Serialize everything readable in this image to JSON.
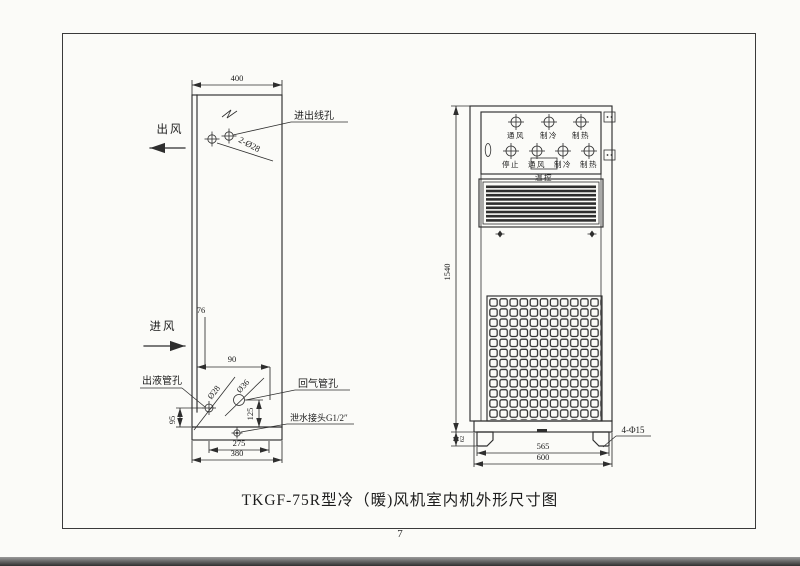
{
  "colors": {
    "ink": "#2e2e2e",
    "paper": "#fbfbf8",
    "frame": "#3a3a3a"
  },
  "page": {
    "title": "TKGF-75R型冷（暖)风机室内机外形尺寸图",
    "page_number": "7"
  },
  "side_view": {
    "air_out_label": "出风",
    "air_in_label": "进风",
    "wire_hole_label": "进出线孔",
    "wire_hole_spec": "2-Ø28",
    "liquid_hole_label": "出液管孔",
    "liquid_hole_spec": "Ø28",
    "gas_hole_label": "回气管孔",
    "gas_hole_spec": "Ø36",
    "drain_label": "泄水接头G1/2″",
    "dim_depth": "400",
    "dim_76": "76",
    "dim_90": "90",
    "dim_95": "95",
    "dim_125": "125",
    "dim_275": "275",
    "dim_380": "380"
  },
  "front_view": {
    "indicator_labels": [
      "通风",
      "制冷",
      "制热"
    ],
    "button_labels": [
      "停止",
      "通风",
      "制冷",
      "制热"
    ],
    "thermostat_label": "温控",
    "dim_height": "1540",
    "dim_base": "62",
    "dim_feet_span": "565",
    "dim_width": "600",
    "foot_hole_spec": "4-Φ15"
  }
}
